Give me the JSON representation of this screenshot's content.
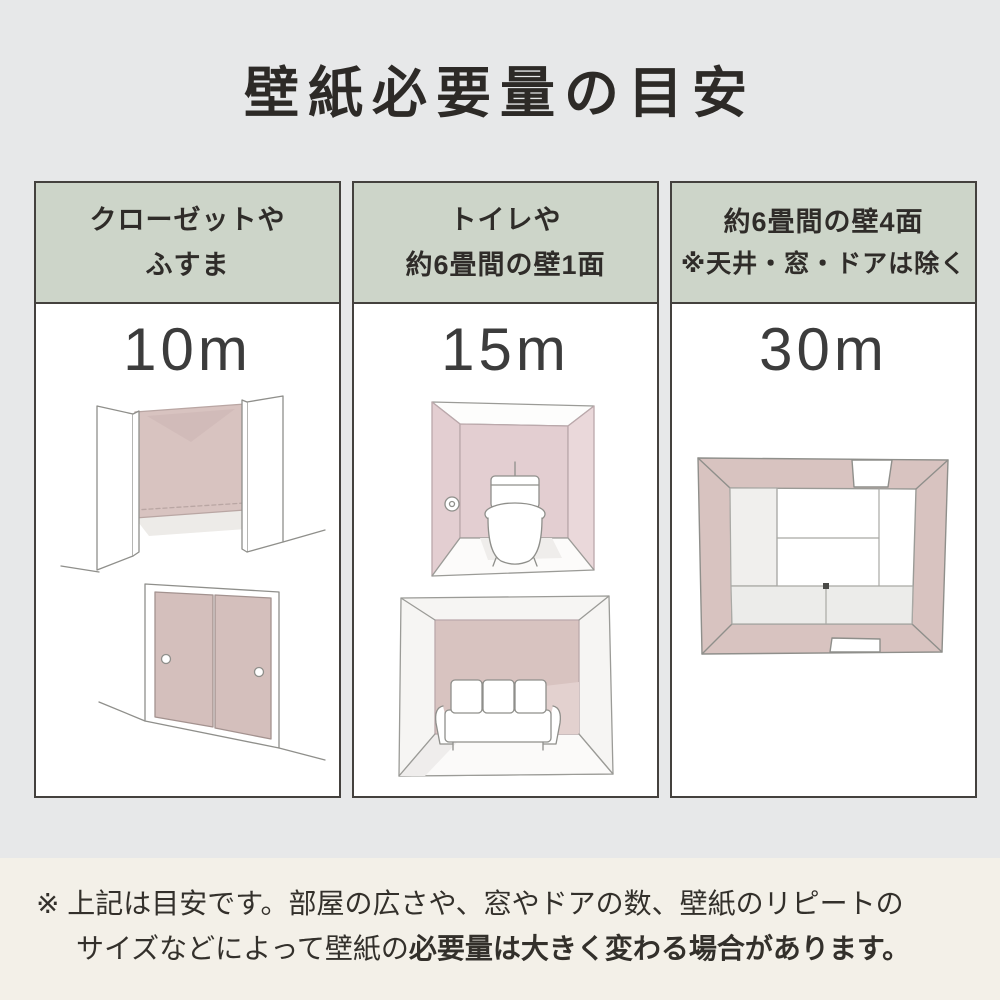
{
  "title": "壁紙必要量の目安",
  "palette": {
    "background_top": "#e7e8e9",
    "background_bottom": "#f3f0e8",
    "header_green": "#cdd5c9",
    "wall_pink": "#d8c3c0",
    "wall_pink_light": "#e3ced1",
    "border_dark": "#44413e",
    "text_dark": "#2d2a27"
  },
  "columns": [
    {
      "header_lines": [
        "クローゼットや",
        "ふすま"
      ],
      "amount": "10m",
      "illustrations": [
        "closet-open-doors",
        "fusuma-sliding-doors"
      ]
    },
    {
      "header_lines": [
        "トイレや",
        "約6畳間の壁1面"
      ],
      "amount": "15m",
      "illustrations": [
        "toilet-room",
        "room-one-accent-wall-sofa"
      ]
    },
    {
      "header_lines": [
        "約6畳間の壁4面",
        "※天井・窓・ドアは除く"
      ],
      "amount": "30m",
      "illustrations": [
        "room-top-view-four-walls"
      ]
    }
  ],
  "footnote": {
    "marker": "※",
    "line1": "上記は目安です。部屋の広さや、窓やドアの数、壁紙のリピートの",
    "line2_normal": "サイズなどによって壁紙の",
    "line2_bold": "必要量は大きく変わる場合があります。"
  }
}
